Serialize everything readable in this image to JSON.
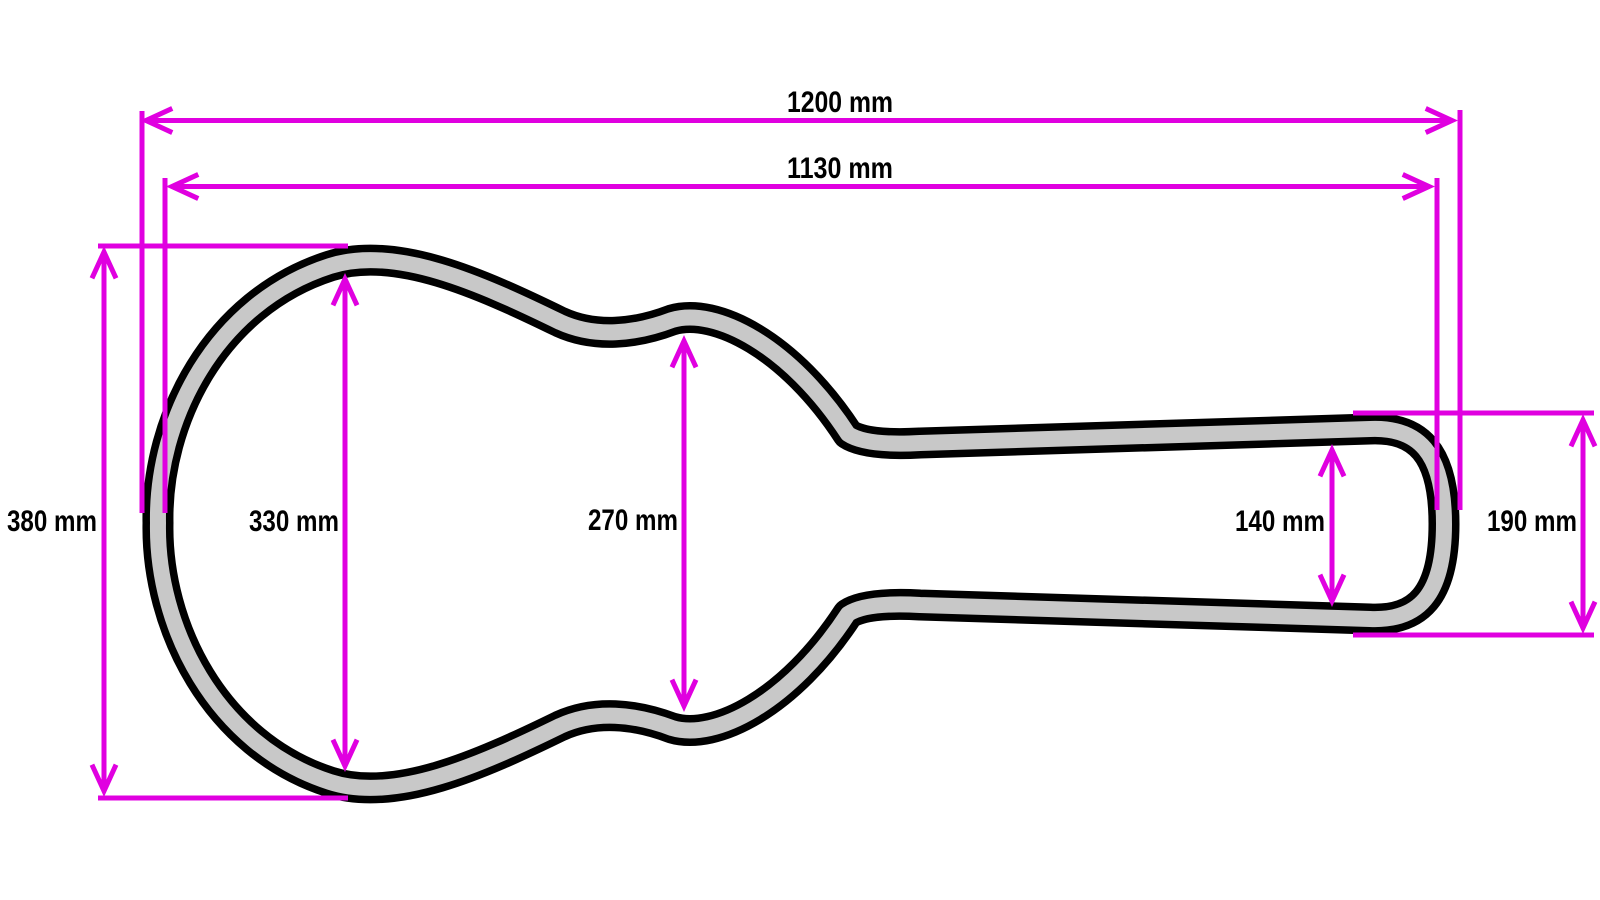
{
  "diagram": {
    "description": "Technical drawing of a guitar case profile with dimension annotations",
    "units": "mm",
    "colors": {
      "dimension_lines": "#E000E0",
      "case_outline": "#000000",
      "case_wall_fill": "#C8C8C8",
      "case_interior": "#FFFFFF",
      "background": "#FFFFFF",
      "label_text": "#000000"
    },
    "dimensions": {
      "overall_length": {
        "label": "1200 mm",
        "value": 1200
      },
      "interior_length": {
        "label": "1130 mm",
        "value": 1130
      },
      "body_outer_height": {
        "label": "380 mm",
        "value": 380
      },
      "body_interior_height": {
        "label": "330 mm",
        "value": 330
      },
      "waist_interior_height": {
        "label": "270 mm",
        "value": 270
      },
      "neck_interior_height": {
        "label": "140 mm",
        "value": 140
      },
      "neck_outer_height": {
        "label": "190 mm",
        "value": 190
      }
    }
  }
}
